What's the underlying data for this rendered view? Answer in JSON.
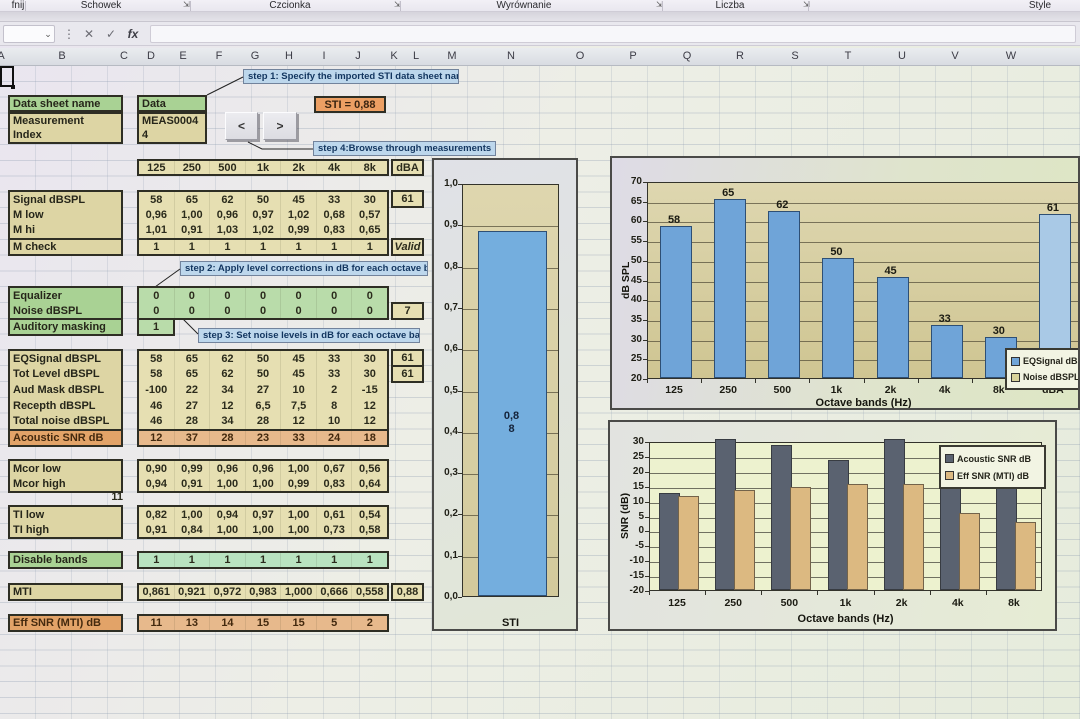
{
  "ribbon": {
    "groups": [
      {
        "label": "fnij",
        "launcher": false
      },
      {
        "label": "Schowek",
        "launcher": true
      },
      {
        "label": "Czcionka",
        "launcher": true
      },
      {
        "label": "Wyrównanie",
        "launcher": true
      },
      {
        "label": "Liczba",
        "launcher": true
      },
      {
        "label": "Style",
        "launcher": false
      }
    ],
    "launcher_glyph": "⇲"
  },
  "formula_bar": {
    "name_box_value": "",
    "chevron": "⌄",
    "dots": "⋮",
    "cancel": "✕",
    "check": "✓",
    "fx": "fx",
    "formula_value": ""
  },
  "column_headers": [
    "A",
    "B",
    "C",
    "D",
    "E",
    "F",
    "G",
    "H",
    "I",
    "J",
    "K",
    "L",
    "M",
    "N",
    "O",
    "P",
    "Q",
    "R",
    "S",
    "T",
    "U",
    "V",
    "W"
  ],
  "callouts": {
    "step1": "step 1: Specify the imported STI data sheet name",
    "step2": "step 2: Apply level corrections in dB  for each octave band",
    "step3": "step 3: Set noise levels  in dB  for each octave band",
    "step4": "step 4:Browse through measurements"
  },
  "panel": {
    "data_sheet_label": "Data sheet name",
    "data_sheet_value": "Data",
    "measurement_label_line1": "Measurement",
    "measurement_label_line2": "Index",
    "measurement_value_line1": "MEAS0004",
    "measurement_value_line2": "4",
    "sti_badge": "STI = 0,88",
    "prev_button": "<",
    "next_button": ">",
    "band_headers": [
      "125",
      "250",
      "500",
      "1k",
      "2k",
      "4k",
      "8k"
    ],
    "dba_header": "dBA",
    "stray_value": "11",
    "rows": [
      {
        "id": "signal",
        "label": "Signal dBSPL",
        "values": [
          "58",
          "65",
          "62",
          "50",
          "45",
          "33",
          "30"
        ],
        "extra": "61"
      },
      {
        "id": "mlow",
        "label": "M low",
        "values": [
          "0,96",
          "1,00",
          "0,96",
          "0,97",
          "1,02",
          "0,68",
          "0,57"
        ]
      },
      {
        "id": "mhi",
        "label": "M hi",
        "values": [
          "1,01",
          "0,91",
          "1,03",
          "1,02",
          "0,99",
          "0,83",
          "0,65"
        ]
      },
      {
        "id": "mcheck",
        "label": "M check",
        "values": [
          "1",
          "1",
          "1",
          "1",
          "1",
          "1",
          "1"
        ],
        "extra": "Valid"
      },
      {
        "id": "equalizer",
        "label": "Equalizer",
        "values": [
          "0",
          "0",
          "0",
          "0",
          "0",
          "0",
          "0"
        ]
      },
      {
        "id": "noise",
        "label": "Noise dBSPL",
        "values": [
          "0",
          "0",
          "0",
          "0",
          "0",
          "0",
          "0"
        ],
        "extra": "7"
      },
      {
        "id": "masking",
        "label": "Auditory masking",
        "values": [
          "1"
        ]
      },
      {
        "id": "eqsignal",
        "label": "EQSignal dBSPL",
        "values": [
          "58",
          "65",
          "62",
          "50",
          "45",
          "33",
          "30"
        ],
        "extra": "61"
      },
      {
        "id": "totlevel",
        "label": "Tot Level dBSPL",
        "values": [
          "58",
          "65",
          "62",
          "50",
          "45",
          "33",
          "30"
        ],
        "extra": "61"
      },
      {
        "id": "audmask",
        "label": "Aud Mask dBSPL",
        "values": [
          "-100",
          "22",
          "34",
          "27",
          "10",
          "2",
          "-15"
        ]
      },
      {
        "id": "recepth",
        "label": "Recepth dBSPL",
        "values": [
          "46",
          "27",
          "12",
          "6,5",
          "7,5",
          "8",
          "12"
        ]
      },
      {
        "id": "totalnoise",
        "label": "Total noise dBSPL",
        "values": [
          "46",
          "28",
          "34",
          "28",
          "12",
          "10",
          "12"
        ]
      },
      {
        "id": "snr",
        "label": "Acoustic SNR dB",
        "values": [
          "12",
          "37",
          "28",
          "23",
          "33",
          "24",
          "18"
        ]
      },
      {
        "id": "mcorlow",
        "label": "Mcor low",
        "values": [
          "0,90",
          "0,99",
          "0,96",
          "0,96",
          "1,00",
          "0,67",
          "0,56"
        ]
      },
      {
        "id": "mcorhigh",
        "label": "Mcor high",
        "values": [
          "0,94",
          "0,91",
          "1,00",
          "1,00",
          "0,99",
          "0,83",
          "0,64"
        ]
      },
      {
        "id": "tilow",
        "label": "TI low",
        "values": [
          "0,82",
          "1,00",
          "0,94",
          "0,97",
          "1,00",
          "0,61",
          "0,54"
        ]
      },
      {
        "id": "tihigh",
        "label": "TI high",
        "values": [
          "0,91",
          "0,84",
          "1,00",
          "1,00",
          "1,00",
          "0,73",
          "0,58"
        ]
      },
      {
        "id": "disable",
        "label": "Disable bands",
        "values": [
          "1",
          "1",
          "1",
          "1",
          "1",
          "1",
          "1"
        ]
      },
      {
        "id": "mti",
        "label": "MTI",
        "values": [
          "0,861",
          "0,921",
          "0,972",
          "0,983",
          "1,000",
          "0,666",
          "0,558"
        ],
        "extra": "0,88"
      },
      {
        "id": "effsnr",
        "label": "Eff SNR (MTI) dB",
        "values": [
          "11",
          "13",
          "14",
          "15",
          "15",
          "5",
          "2"
        ]
      }
    ]
  },
  "chart_data": [
    {
      "type": "bar",
      "name": "sti-gauge",
      "categories": [
        "STI"
      ],
      "values": [
        0.88
      ],
      "bar_label_lines": [
        "0,8",
        "8"
      ],
      "xlabel": "STI",
      "ylim": [
        0,
        1
      ],
      "ytick_step": 0.1,
      "bar_color": "#74aede",
      "grid": true,
      "legend": false
    },
    {
      "type": "bar",
      "name": "spl-by-octave",
      "categories": [
        "125",
        "250",
        "500",
        "1k",
        "2k",
        "4k",
        "8k",
        "dBA"
      ],
      "series": [
        {
          "name": "EQSignal dBSPL",
          "values": [
            58,
            65,
            62,
            50,
            45,
            33,
            30,
            61
          ],
          "color": "#6fa4d8"
        },
        {
          "name": "Noise dBSPL",
          "values": [
            0,
            0,
            0,
            0,
            0,
            0,
            0,
            7
          ],
          "color": "#d8d29a"
        }
      ],
      "data_labels": [
        "58",
        "65",
        "62",
        "50",
        "45",
        "33",
        "30",
        "61"
      ],
      "xlabel": "Octave bands (Hz)",
      "ylabel": "dB SPL",
      "ylim": [
        20,
        70
      ],
      "ytick_step": 5,
      "dba_bar_color": "#a9c9e6",
      "grid": true,
      "legend_position": "bottom-right"
    },
    {
      "type": "bar",
      "name": "snr-by-octave",
      "categories": [
        "125",
        "250",
        "500",
        "1k",
        "2k",
        "4k",
        "8k"
      ],
      "series": [
        {
          "name": "Acoustic SNR dB",
          "values": [
            12,
            37,
            28,
            23,
            33,
            24,
            18
          ],
          "color": "#5a6270"
        },
        {
          "name": "Eff SNR (MTI) dB",
          "values": [
            11,
            13,
            14,
            15,
            15,
            5,
            2
          ],
          "color": "#dcb981"
        }
      ],
      "xlabel": "Octave bands (Hz)",
      "ylabel": "SNR (dB)",
      "ylim": [
        -20,
        30
      ],
      "ytick_step": 5,
      "grid": true,
      "legend_position": "top-right"
    }
  ]
}
